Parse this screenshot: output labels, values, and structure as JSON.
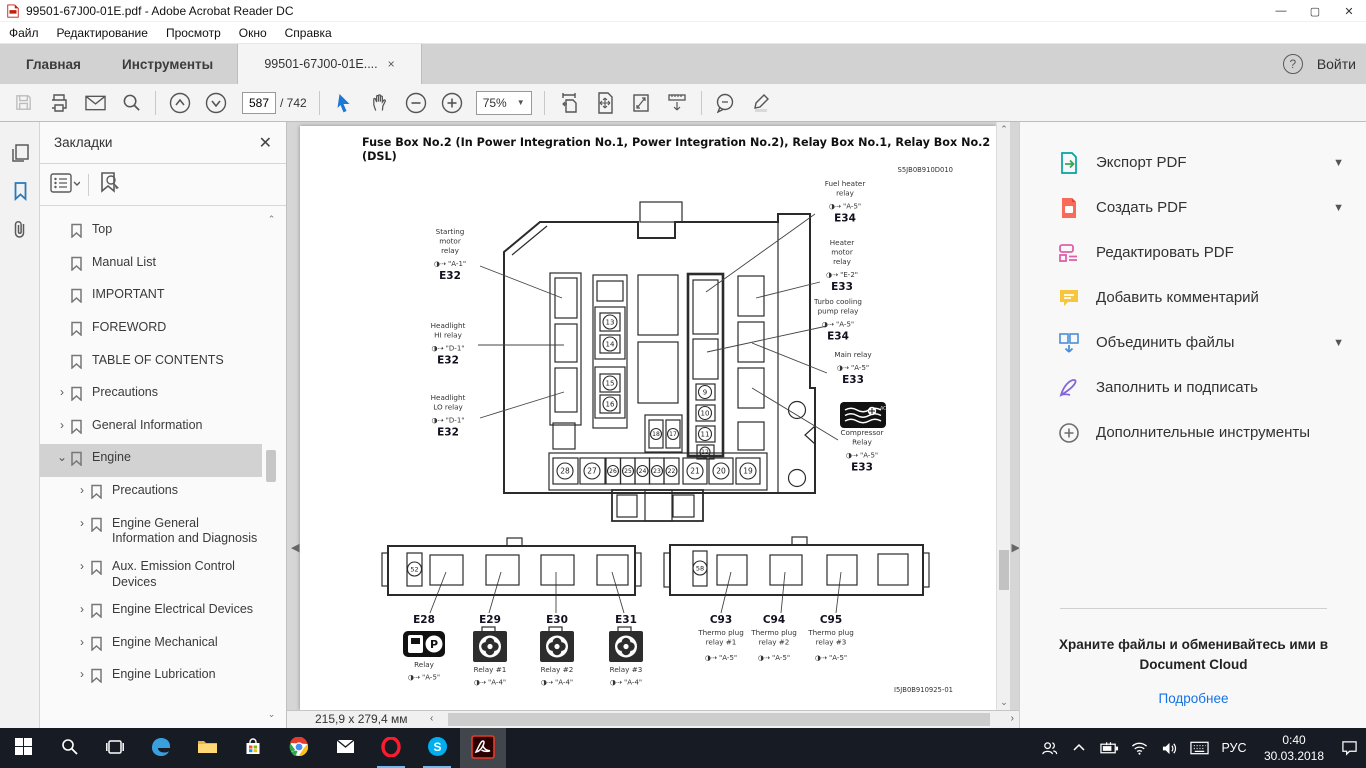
{
  "window": {
    "title": "99501-67J00-01E.pdf - Adobe Acrobat Reader DC"
  },
  "menu": {
    "items": [
      "Файл",
      "Редактирование",
      "Просмотр",
      "Окно",
      "Справка"
    ]
  },
  "tabs": {
    "home": "Главная",
    "tools": "Инструменты",
    "doc": "99501-67J00-01E....",
    "close": "×",
    "sign_in": "Войти",
    "help": "?"
  },
  "toolbar": {
    "page_current": "587",
    "page_total": "/ 742",
    "zoom": "75%"
  },
  "bookmarks_panel": {
    "title": "Закладки",
    "items": [
      {
        "label": "Top",
        "indent": 0,
        "expand": "none",
        "selected": false
      },
      {
        "label": "Manual List",
        "indent": 0,
        "expand": "none",
        "selected": false
      },
      {
        "label": "IMPORTANT",
        "indent": 0,
        "expand": "none",
        "selected": false
      },
      {
        "label": "FOREWORD",
        "indent": 0,
        "expand": "none",
        "selected": false
      },
      {
        "label": "TABLE OF CONTENTS",
        "indent": 0,
        "expand": "none",
        "selected": false
      },
      {
        "label": "Precautions",
        "indent": 0,
        "expand": "closed",
        "selected": false
      },
      {
        "label": "General Information",
        "indent": 0,
        "expand": "closed",
        "selected": false
      },
      {
        "label": "Engine",
        "indent": 0,
        "expand": "open",
        "selected": true
      },
      {
        "label": "Precautions",
        "indent": 1,
        "expand": "closed",
        "selected": false
      },
      {
        "label": "Engine General Information and Diagnosis",
        "indent": 1,
        "expand": "closed",
        "selected": false
      },
      {
        "label": "Aux. Emission Control Devices",
        "indent": 1,
        "expand": "closed",
        "selected": false
      },
      {
        "label": "Engine Electrical Devices",
        "indent": 1,
        "expand": "closed",
        "selected": false
      },
      {
        "label": "Engine Mechanical",
        "indent": 1,
        "expand": "closed",
        "selected": false
      },
      {
        "label": "Engine Lubrication",
        "indent": 1,
        "expand": "closed",
        "selected": false
      }
    ]
  },
  "pdf": {
    "title_line1": "Fuse Box No.2 (In Power Integration No.1, Power Integration No.2), Relay Box No.1, Relay Box No.2",
    "title_line2": "(DSL)",
    "doc_code_top": "S5JB0B910D010",
    "doc_code_bottom": "I5JB0B910925-01",
    "fuses": {
      "mid": [
        "13",
        "14",
        "15",
        "16"
      ],
      "right_col": [
        "9",
        "10",
        "11",
        "12"
      ],
      "center_pair": [
        "18",
        "17"
      ],
      "bottom_row": [
        "28",
        "27",
        "26",
        "25",
        "24",
        "23",
        "22",
        "21",
        "20",
        "19"
      ],
      "left_box": "52",
      "right_box": "58"
    },
    "callouts": [
      {
        "key": "starting",
        "name": "Starting\nmotor\nrelay",
        "ref": "◑⇢ \"A-1\"",
        "id": "E32"
      },
      {
        "key": "headlight_hi",
        "name": "Headlight\nHI relay",
        "ref": "◑⇢ \"D-1\"",
        "id": "E32"
      },
      {
        "key": "headlight_lo",
        "name": "Headlight\nLO relay",
        "ref": "◑⇢ \"D-1\"",
        "id": "E32"
      },
      {
        "key": "fuel_heater",
        "name": "Fuel heater\nrelay",
        "ref": "◑⇢ \"A-5\"",
        "id": "E34"
      },
      {
        "key": "heater_motor",
        "name": "Heater\nmotor\nrelay",
        "ref": "◑⇢ \"E-2\"",
        "id": "E33"
      },
      {
        "key": "turbo",
        "name": "Turbo cooling\npump relay",
        "ref": "◑⇢ \"A-5\"",
        "id": "E34"
      },
      {
        "key": "main",
        "name": "Main relay",
        "ref": "◑⇢ \"A-5\"",
        "id": "E33"
      },
      {
        "key": "compressor",
        "name": "Compressor\nRelay",
        "ref": "◑⇢ \"A-5\"",
        "id": "E33"
      }
    ],
    "bottom_left_units": [
      {
        "id": "E28",
        "name": "Relay",
        "ref": "◑⇢ \"A-5\"",
        "icon": "fuel-pump"
      },
      {
        "id": "E29",
        "name": "Relay #1",
        "ref": "◑⇢ \"A-4\"",
        "icon": "fan"
      },
      {
        "id": "E30",
        "name": "Relay #2",
        "ref": "◑⇢ \"A-4\"",
        "icon": "fan"
      },
      {
        "id": "E31",
        "name": "Relay #3",
        "ref": "◑⇢ \"A-4\"",
        "icon": "fan"
      }
    ],
    "bottom_right_units": [
      {
        "id": "C93",
        "name": "Thermo plug\nrelay #1",
        "ref": "◑⇢ \"A-5\""
      },
      {
        "id": "C94",
        "name": "Thermo plug\nrelay #2",
        "ref": "◑⇢ \"A-5\""
      },
      {
        "id": "C95",
        "name": "Thermo plug\nrelay #3",
        "ref": "◑⇢ \"A-5\""
      }
    ]
  },
  "statusbar": {
    "dimensions": "215,9 x 279,4 мм"
  },
  "right_panel": {
    "tools": [
      {
        "key": "export-pdf",
        "label": "Экспорт PDF",
        "chevron": true
      },
      {
        "key": "create-pdf",
        "label": "Создать PDF",
        "chevron": true
      },
      {
        "key": "edit-pdf",
        "label": "Редактировать PDF",
        "chevron": false
      },
      {
        "key": "add-comment",
        "label": "Добавить комментарий",
        "chevron": false
      },
      {
        "key": "combine-files",
        "label": "Объединить файлы",
        "chevron": true
      },
      {
        "key": "fill-sign",
        "label": "Заполнить и подписать",
        "chevron": false
      },
      {
        "key": "more-tools",
        "label": "Дополнительные инструменты",
        "chevron": false
      }
    ],
    "cloud": {
      "line1": "Храните файлы и обменивайтесь ими в",
      "line2": "Document Cloud",
      "link": "Подробнее"
    }
  },
  "taskbar": {
    "apps": [
      {
        "name": "start",
        "running": false,
        "active": false
      },
      {
        "name": "search",
        "running": false,
        "active": false
      },
      {
        "name": "task-view",
        "running": false,
        "active": false
      },
      {
        "name": "edge",
        "running": false,
        "active": false
      },
      {
        "name": "file-explorer",
        "running": false,
        "active": false
      },
      {
        "name": "store",
        "running": false,
        "active": false
      },
      {
        "name": "chrome",
        "running": false,
        "active": false
      },
      {
        "name": "mail",
        "running": false,
        "active": false
      },
      {
        "name": "opera",
        "running": true,
        "active": false
      },
      {
        "name": "skype",
        "running": true,
        "active": false
      },
      {
        "name": "acrobat",
        "running": true,
        "active": true
      }
    ],
    "lang": "РУС",
    "time": "0:40",
    "date": "30.03.2018"
  },
  "accent_colors": {
    "selection_blue": "#2a7ab9",
    "link_blue": "#1473e6",
    "acrobat_red": "#c11e0f",
    "taskbar_dark": "#171c24"
  }
}
